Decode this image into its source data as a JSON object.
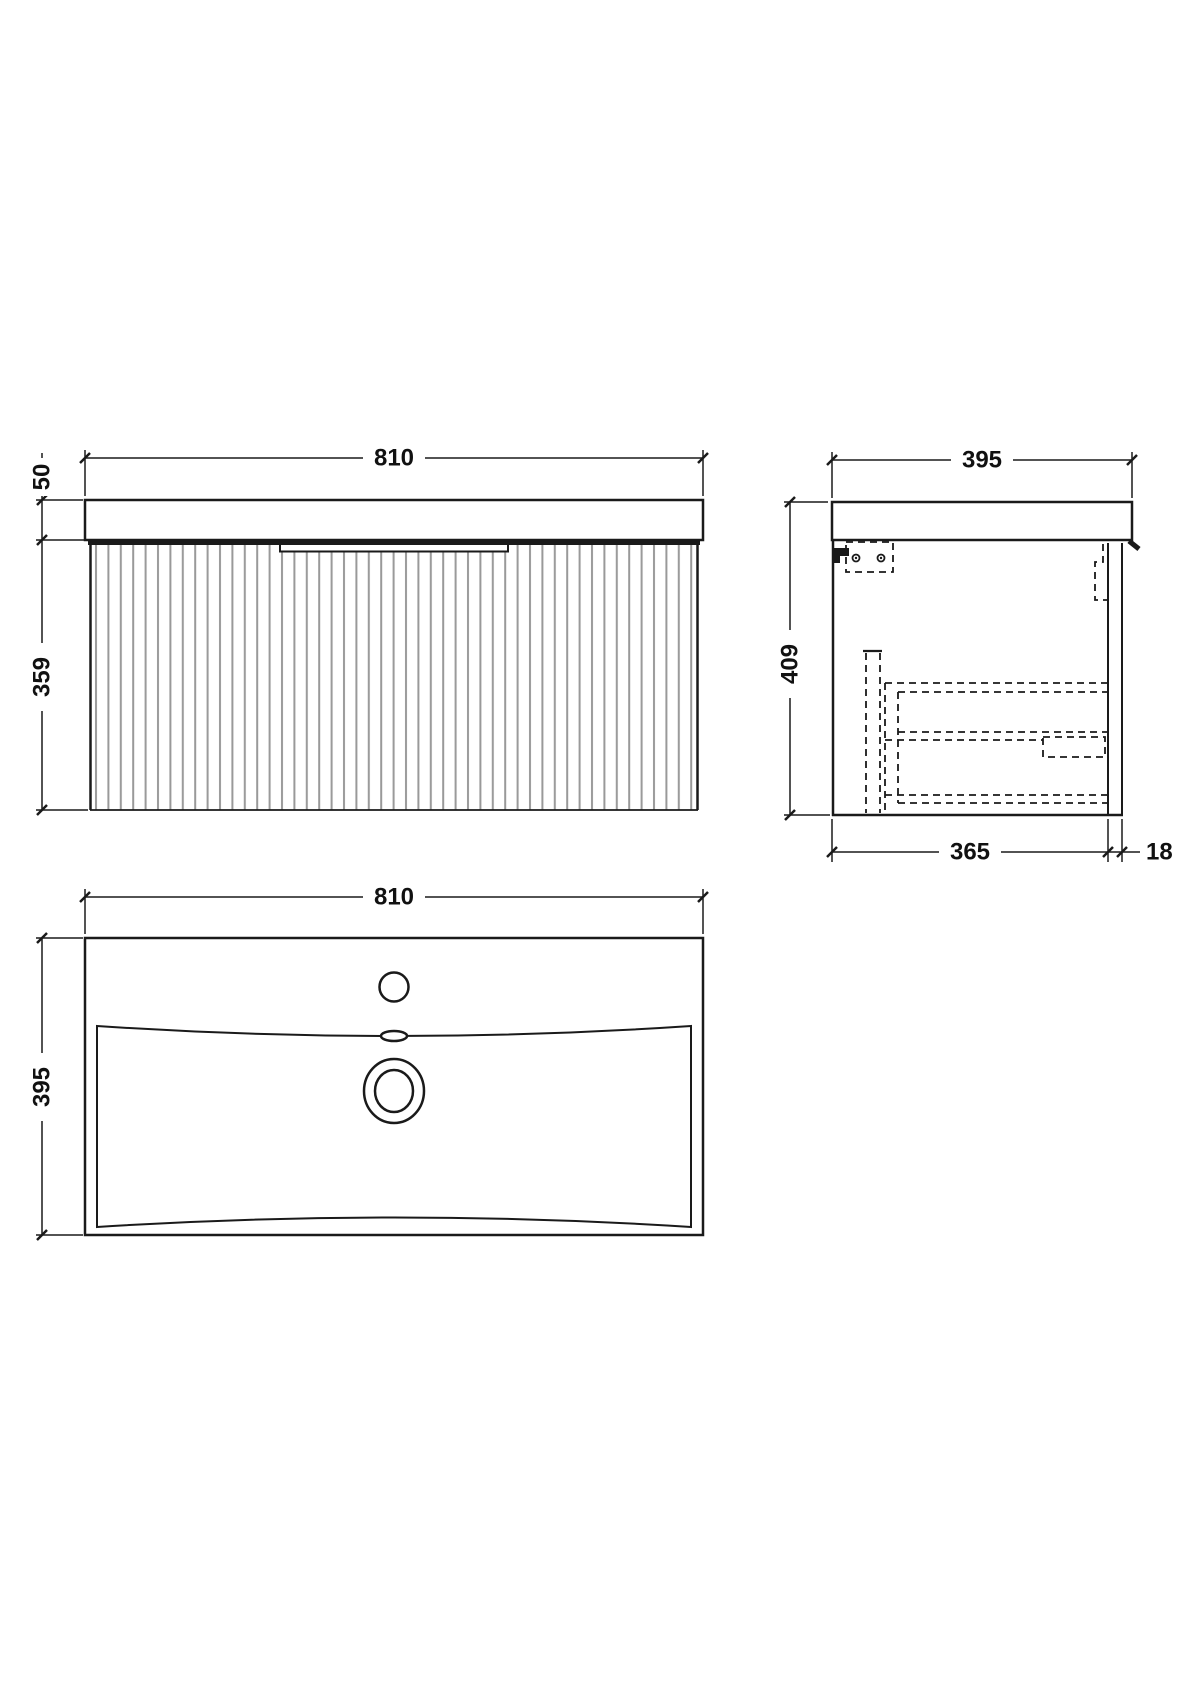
{
  "drawing": {
    "kind": "vanity-unit-and-basin-technical-drawing",
    "colors": {
      "line": "#1a1a1a",
      "flute": "#999999",
      "background": "#ffffff"
    },
    "views": {
      "front": {
        "width_label": "810",
        "worktop_thickness_label": "50",
        "cabinet_height_label": "359"
      },
      "side": {
        "depth_label": "395",
        "overall_height_label": "409",
        "cabinet_depth_label": "365",
        "front_panel_thickness_label": "18"
      },
      "basin": {
        "width_label": "810",
        "depth_label": "395"
      }
    }
  }
}
